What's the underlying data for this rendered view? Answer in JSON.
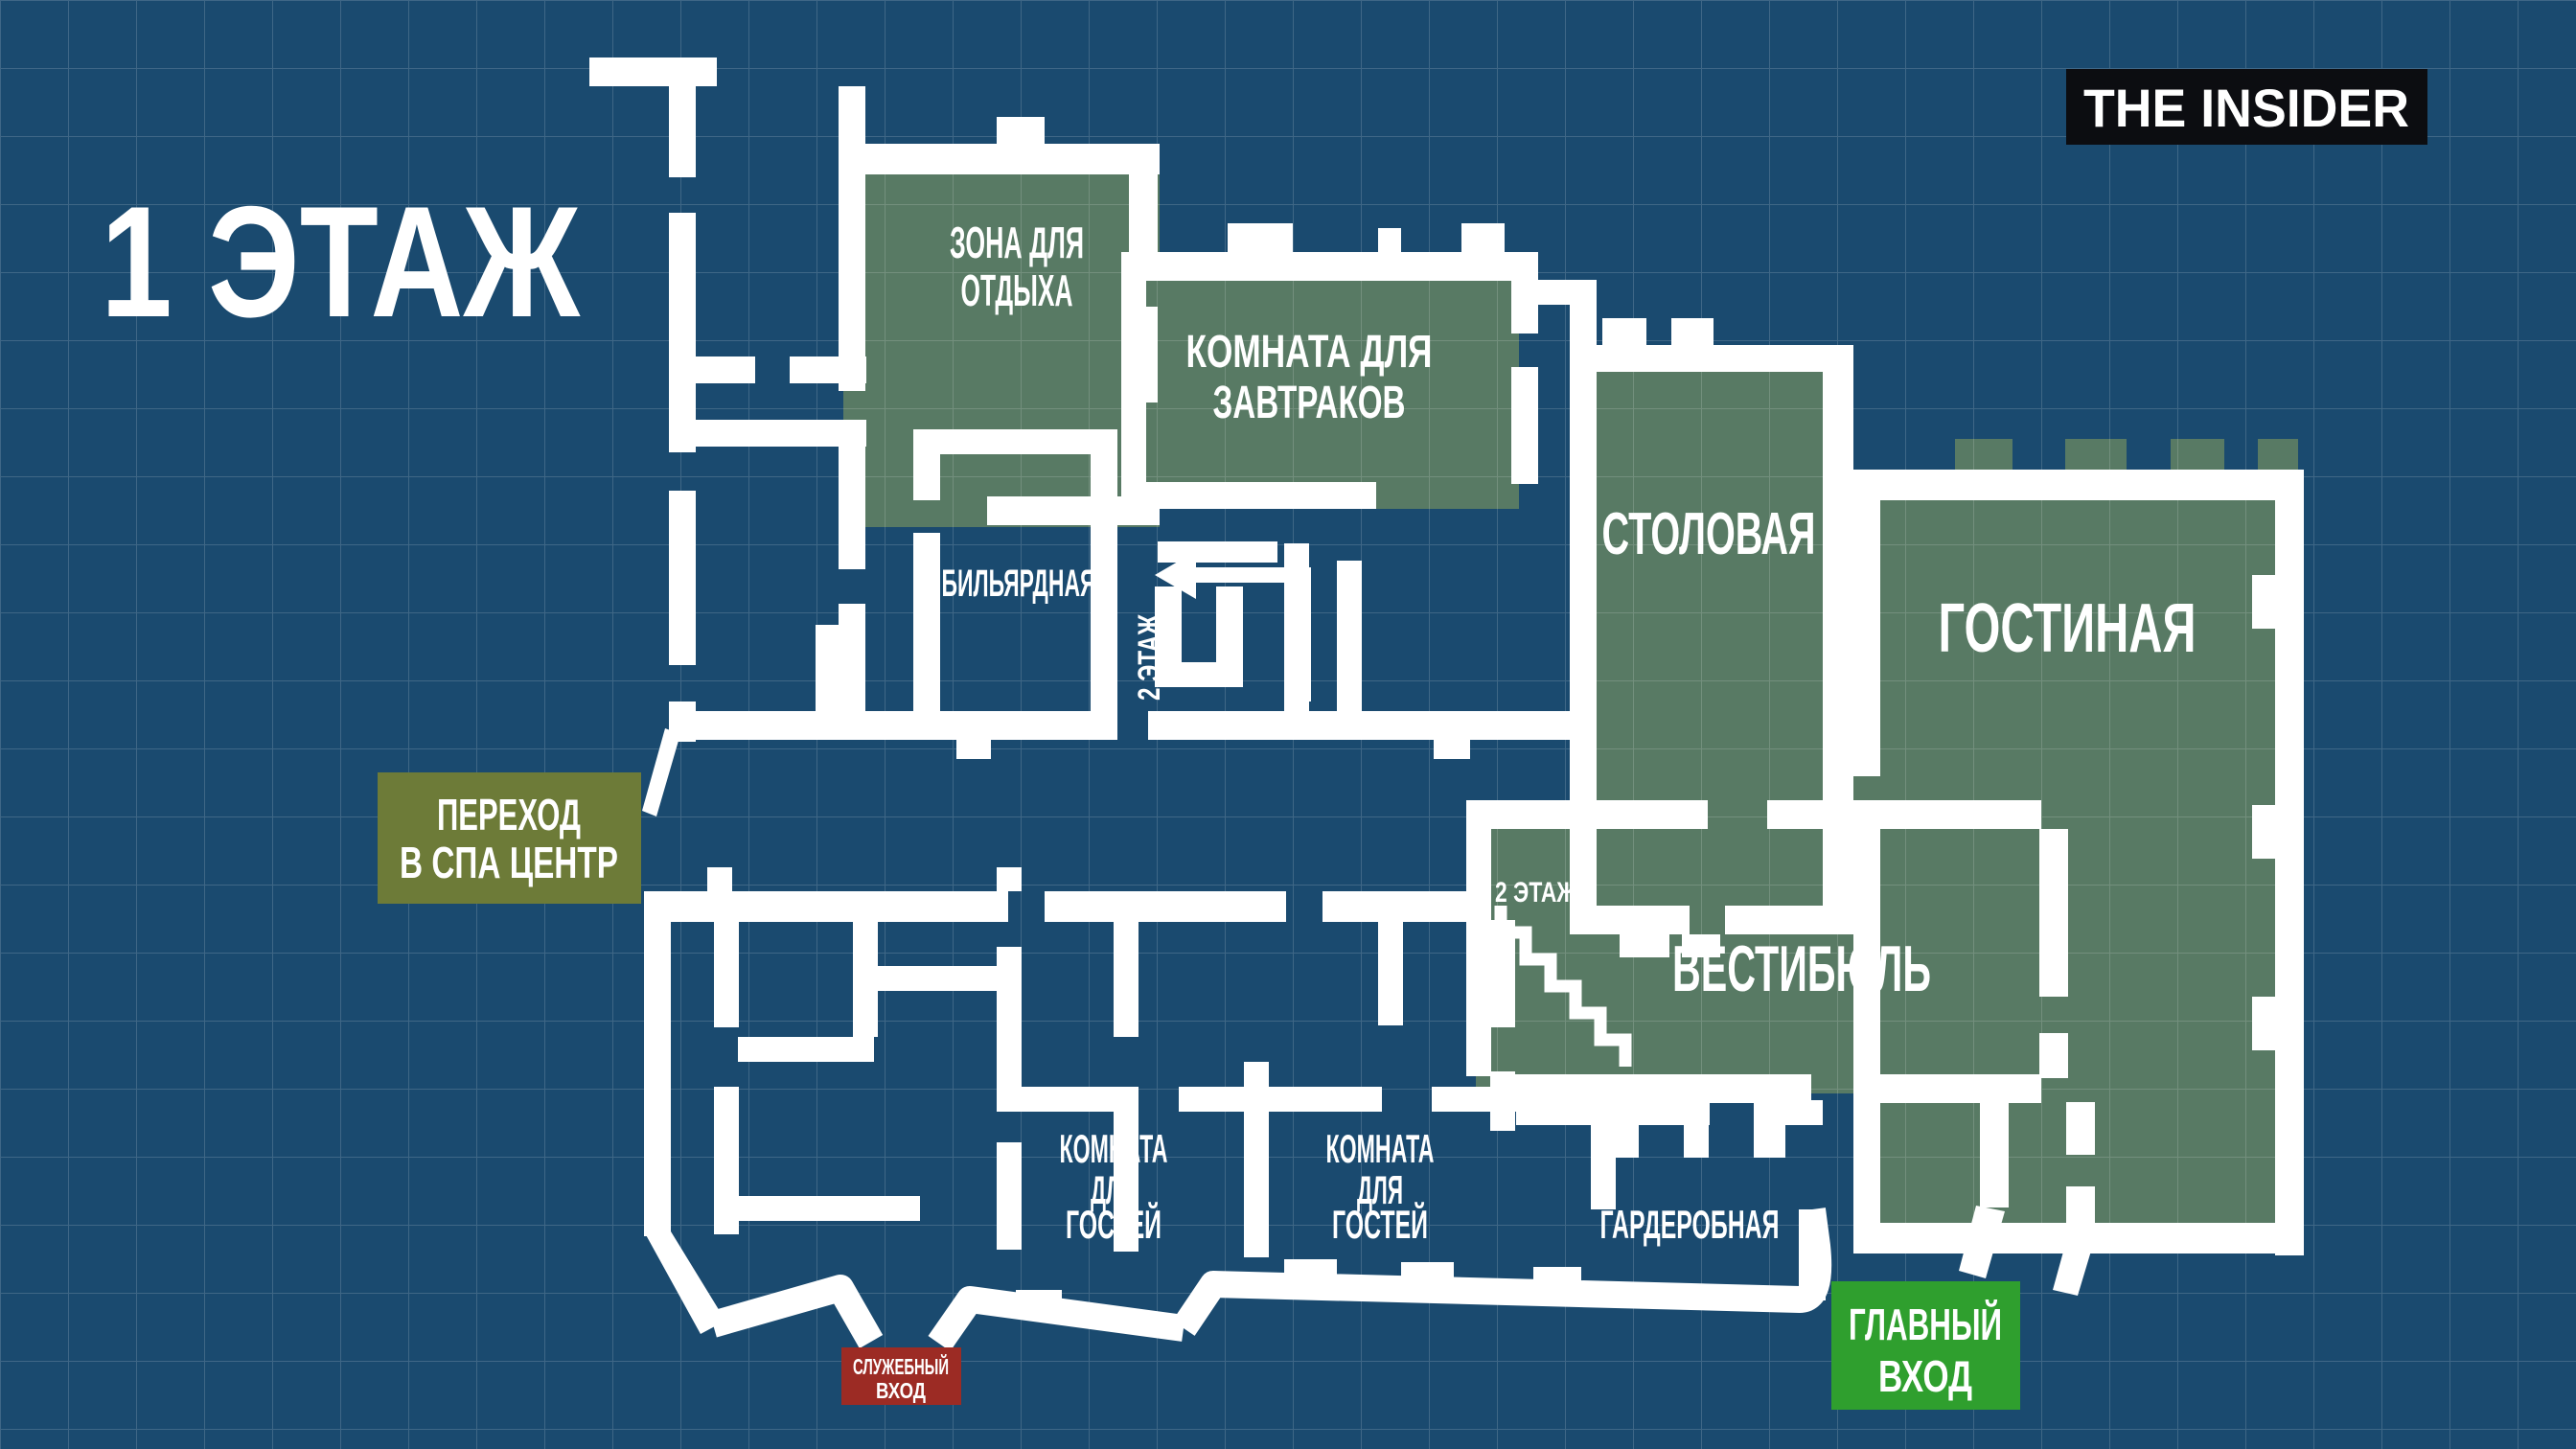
{
  "title": "1 ЭТАЖ",
  "logo": "THE INSIDER",
  "colors": {
    "background": "#1a4a6f",
    "grid_line": "rgba(255,255,255,0.16)",
    "room_green": "#587a64",
    "wall_white": "#ffffff",
    "text_white": "#ffffff",
    "spa_olive": "#6d7b38",
    "entrance_green": "#2f9f2e",
    "service_red": "#9c2b24",
    "logo_black": "#0c0d11"
  },
  "rooms": {
    "rest_area": {
      "lines": [
        "ЗОНА ДЛЯ",
        "ОТДЫХА"
      ]
    },
    "breakfast": {
      "lines": [
        "КОМНАТА ДЛЯ",
        "ЗАВТРАКОВ"
      ]
    },
    "billiard": {
      "name": "БИЛЬЯРДНАЯ"
    },
    "dining": {
      "name": "СТОЛОВАЯ"
    },
    "living": {
      "name": "ГОСТИНАЯ"
    },
    "vestibule": {
      "name": "ВЕСТИБЮЛЬ"
    },
    "guest1": {
      "lines": [
        "КОМНАТА",
        "ДЛЯ",
        "ГОСТЕЙ"
      ]
    },
    "guest2": {
      "lines": [
        "КОМНАТА",
        "ДЛЯ",
        "ГОСТЕЙ"
      ]
    },
    "wardrobe": {
      "name": "ГАРДЕРОБНАЯ"
    }
  },
  "stairs": {
    "floor2_center": "2 ЭТАЖ",
    "floor2_vestibule": "2 ЭТАЖ"
  },
  "markers": {
    "spa": {
      "lines": [
        "ПЕРЕХОД",
        "В СПА ЦЕНТР"
      ]
    },
    "service": {
      "lines": [
        "СЛУЖЕБНЫЙ",
        "ВХОД"
      ]
    },
    "main": {
      "lines": [
        "ГЛАВНЫЙ",
        "ВХОД"
      ]
    }
  }
}
